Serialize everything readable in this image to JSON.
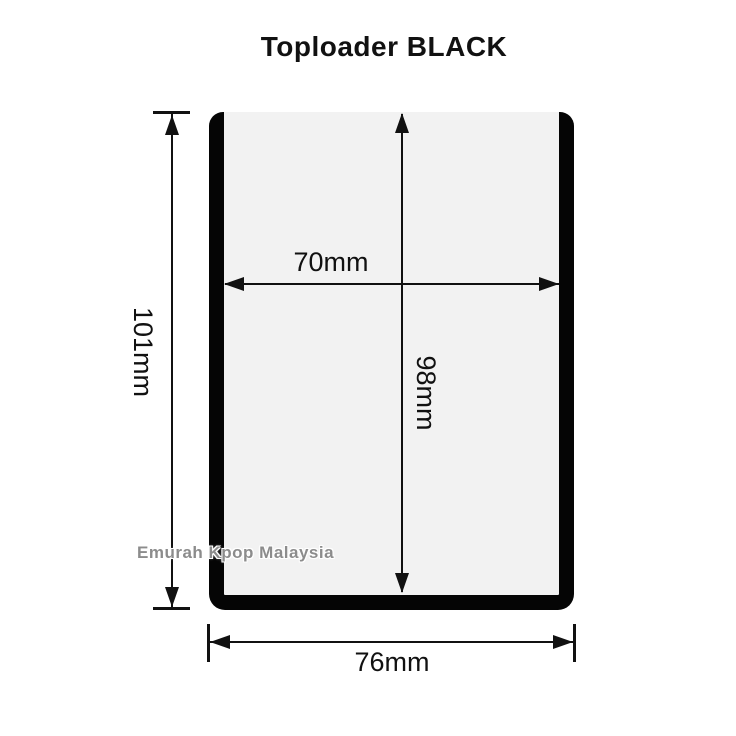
{
  "title": "Toploader BLACK",
  "watermark": "Emurah Kpop Malaysia",
  "dimensions": {
    "overall_height": "101mm",
    "inner_width": "70mm",
    "inner_height": "98mm",
    "overall_width": "76mm"
  },
  "colors": {
    "background": "#ffffff",
    "line_and_text": "#111111",
    "toploader_black": "#050505",
    "toploader_interior": "#f2f2f2",
    "watermark_gray": "#8c8c8c",
    "watermark_outline": "#ffffff"
  }
}
